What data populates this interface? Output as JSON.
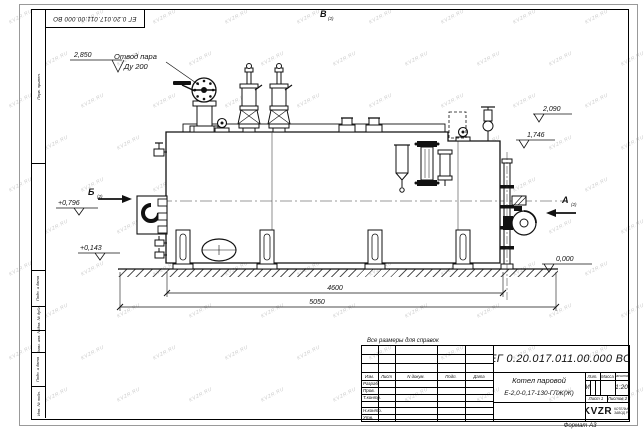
{
  "watermark": {
    "text": "KVZR.RU"
  },
  "sheet": {
    "format_note": "Формат А3",
    "doc_number_rotated": "ЕГ 0.20.017.011.00.000  ВО",
    "margin_fields": {
      "perv_primen": "Перв. примен.",
      "podp_data_1": "Подп. и дата",
      "inv_dubl": "Инв. № дубл.",
      "vzam_inv": "Взам. инв. №",
      "podp_data_2": "Подп. и дата",
      "inv_podl": "Инв. № подл."
    }
  },
  "drawing": {
    "callouts": {
      "steam_outlet_line1": "Отвод пара",
      "steam_outlet_line2": "Ду 200"
    },
    "views": {
      "top": "В",
      "top_sub": "(2)",
      "left": "Б",
      "left_sub": "(2)",
      "right": "А",
      "right_sub": "(2)"
    },
    "elevations": {
      "steam_valve": "2,850",
      "upper_right": "2,090",
      "mid_right": "1,746",
      "burner": "+0,796",
      "lower_left": "+0,143",
      "ground": "0,000"
    },
    "dimensions": {
      "support_span": "4600",
      "overall_length": "5050"
    }
  },
  "title_block": {
    "reference_note": "Все размеры для справок",
    "doc_number": "ЕГ 0.20.017.011.00.000  ВО",
    "product_name_line1": "Котел паровой",
    "product_name_line2": "Е-2,0-0,17-130-ГЛЖ(Ж)",
    "columns": {
      "izm": "Изм.",
      "list": "Лист",
      "doc": "N докум.",
      "podp": "Подп.",
      "data": "Дата"
    },
    "rows": {
      "razrab": "Разраб.",
      "prov": "Пров.",
      "tkontr": "Т.контр.",
      "nkontr": "Н.контр.",
      "utv": "Утв."
    },
    "lit_label": "Лит.",
    "lit_value": "И",
    "mass_label": "Масса",
    "scale_label": "Масштаб",
    "scale_value": "1:20",
    "sheet_label": "Лист 1",
    "sheets_label": "Листов 2",
    "logo": "KVZR",
    "company_line1": "КОТЕЛЬНЫЙ",
    "company_line2": "ЗАВОД РЭП"
  }
}
